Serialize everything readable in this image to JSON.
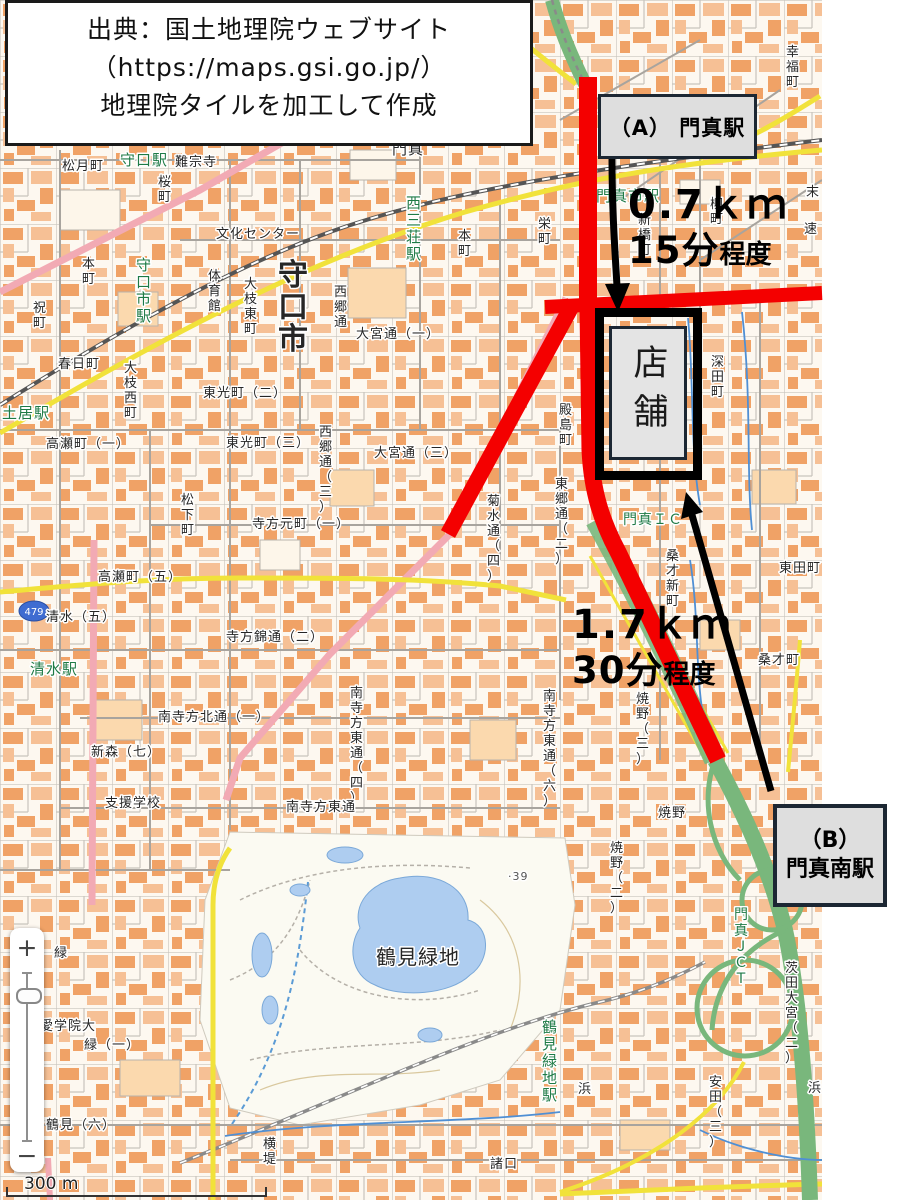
{
  "attribution": {
    "line1": "出典：国土地理院ウェブサイト",
    "line2": "（https://maps.gsi.go.jp/）",
    "line3": "地理院タイルを加工して作成"
  },
  "annotations": {
    "station_a_label": "（A） 門真駅",
    "station_b_line1": "（B）",
    "station_b_line2": "門真南駅",
    "store_label": "店舗",
    "route_a_distance": "0.7ｋｍ",
    "route_a_duration": "15分",
    "route_a_duration_note": "程度",
    "route_b_distance": "1.7ｋｍ",
    "route_b_duration": "30分",
    "route_b_duration_note": "程度",
    "route_color": "#f40000",
    "arrow_color": "#000000"
  },
  "map_controls": {
    "zoom_in": "+",
    "zoom_out": "−",
    "scale_label": "300 m"
  },
  "map": {
    "route_shield": "479",
    "labels": [
      {
        "t": "守口駅",
        "x": 120,
        "y": 150,
        "c": "#1e7a45",
        "s": 15
      },
      {
        "t": "松月町",
        "x": 62,
        "y": 157
      },
      {
        "t": "難宗寺",
        "x": 175,
        "y": 153
      },
      {
        "t": "桜町",
        "x": 158,
        "y": 173,
        "v": 1
      },
      {
        "t": "本町",
        "x": 82,
        "y": 255,
        "v": 1
      },
      {
        "t": "祝町",
        "x": 33,
        "y": 299,
        "v": 1
      },
      {
        "t": "守口市駅",
        "x": 136,
        "y": 255,
        "v": 1,
        "c": "#1e7a45",
        "s": 15
      },
      {
        "t": "春日町",
        "x": 58,
        "y": 355
      },
      {
        "t": "大枝西町",
        "x": 124,
        "y": 359,
        "v": 1
      },
      {
        "t": "土居駅",
        "x": 2,
        "y": 403,
        "c": "#1e7a45",
        "s": 15
      },
      {
        "t": "文化センター",
        "x": 216,
        "y": 225
      },
      {
        "t": "守口市",
        "x": 278,
        "y": 255,
        "v": 1,
        "s": 30,
        "w": 600
      },
      {
        "t": "体育館",
        "x": 208,
        "y": 267,
        "v": 1
      },
      {
        "t": "大枝東町",
        "x": 244,
        "y": 275,
        "v": 1
      },
      {
        "t": "西郷通",
        "x": 334,
        "y": 283,
        "v": 1
      },
      {
        "t": "大宮通（一）",
        "x": 356,
        "y": 325
      },
      {
        "t": "東光町（二）",
        "x": 203,
        "y": 384
      },
      {
        "t": "西三荘駅",
        "x": 406,
        "y": 193,
        "v": 1,
        "c": "#1e7a45",
        "s": 15
      },
      {
        "t": "門真",
        "x": 392,
        "y": 139,
        "s": 15
      },
      {
        "t": "東光町（三）",
        "x": 226,
        "y": 434
      },
      {
        "t": "西郷通（三）",
        "x": 319,
        "y": 423,
        "v": 1
      },
      {
        "t": "大宮通（三）",
        "x": 374,
        "y": 444
      },
      {
        "t": "松下町",
        "x": 181,
        "y": 491,
        "v": 1
      },
      {
        "t": "寺方元町（一）",
        "x": 252,
        "y": 515
      },
      {
        "t": "菊水通（四）",
        "x": 487,
        "y": 492,
        "v": 1
      },
      {
        "t": "東郷通（二）",
        "x": 555,
        "y": 475,
        "v": 1
      },
      {
        "t": "殿島町",
        "x": 559,
        "y": 401,
        "v": 1
      },
      {
        "t": "高瀬町（一）",
        "x": 46,
        "y": 435
      },
      {
        "t": "高瀬町（五）",
        "x": 98,
        "y": 568
      },
      {
        "t": "清水（五）",
        "x": 46,
        "y": 608
      },
      {
        "t": "清水駅",
        "x": 30,
        "y": 659,
        "c": "#1e7a45",
        "s": 15
      },
      {
        "t": "新森（七）",
        "x": 91,
        "y": 743
      },
      {
        "t": "支援学校",
        "x": 105,
        "y": 794
      },
      {
        "t": "寺方錦通（二）",
        "x": 226,
        "y": 628
      },
      {
        "t": "南寺方北通（一）",
        "x": 158,
        "y": 708
      },
      {
        "t": "南寺方東通（四）",
        "x": 350,
        "y": 684,
        "v": 1
      },
      {
        "t": "南寺方東通（六）",
        "x": 543,
        "y": 687,
        "v": 1
      },
      {
        "t": "南寺方東通",
        "x": 286,
        "y": 798
      },
      {
        "t": "栄町",
        "x": 538,
        "y": 215,
        "v": 1
      },
      {
        "t": "本町",
        "x": 458,
        "y": 227,
        "v": 1
      },
      {
        "t": "門真市駅",
        "x": 596,
        "y": 186,
        "c": "#1e7a45",
        "s": 15
      },
      {
        "t": "柳町",
        "x": 710,
        "y": 195,
        "v": 1
      },
      {
        "t": "新橋町",
        "x": 638,
        "y": 211,
        "v": 1
      },
      {
        "t": "幸福町",
        "x": 786,
        "y": 43,
        "v": 1
      },
      {
        "t": "末",
        "x": 806,
        "y": 183
      },
      {
        "t": "速",
        "x": 804,
        "y": 220
      },
      {
        "t": "深田町",
        "x": 711,
        "y": 353,
        "v": 1
      },
      {
        "t": "東田町",
        "x": 779,
        "y": 559
      },
      {
        "t": "桑才新町",
        "x": 666,
        "y": 547,
        "v": 1
      },
      {
        "t": "桑才町",
        "x": 758,
        "y": 651
      },
      {
        "t": "門真ＩＣ",
        "x": 623,
        "y": 510,
        "c": "#1e7a45",
        "s": 14
      },
      {
        "t": "焼野（三）",
        "x": 636,
        "y": 690,
        "v": 1
      },
      {
        "t": "焼野",
        "x": 658,
        "y": 804
      },
      {
        "t": "焼野（二）",
        "x": 610,
        "y": 839,
        "v": 1
      },
      {
        "t": "門真ＪＣＴ",
        "x": 734,
        "y": 905,
        "v": 1,
        "c": "#1e7a45",
        "s": 14
      },
      {
        "t": "茨田大宮（二）",
        "x": 785,
        "y": 959,
        "v": 1
      },
      {
        "t": "安田（三）",
        "x": 709,
        "y": 1073,
        "v": 1
      },
      {
        "t": "浜",
        "x": 808,
        "y": 1079
      },
      {
        "t": "鶴見緑地",
        "x": 376,
        "y": 944,
        "s": 20
      },
      {
        "t": "鶴見緑地駅",
        "x": 542,
        "y": 1017,
        "v": 1,
        "c": "#1e7a45",
        "s": 15
      },
      {
        "t": "愛学院大",
        "x": 40,
        "y": 1017
      },
      {
        "t": "緑",
        "x": 54,
        "y": 944
      },
      {
        "t": "緑（一）",
        "x": 84,
        "y": 1036
      },
      {
        "t": "鶴見（六）",
        "x": 46,
        "y": 1116
      },
      {
        "t": "横堤",
        "x": 263,
        "y": 1135,
        "v": 1
      },
      {
        "t": "諸口",
        "x": 490,
        "y": 1155
      },
      {
        "t": "浜",
        "x": 578,
        "y": 1080
      },
      {
        "t": "·39",
        "x": 508,
        "y": 869,
        "s": 11,
        "c": "#555555"
      }
    ]
  }
}
